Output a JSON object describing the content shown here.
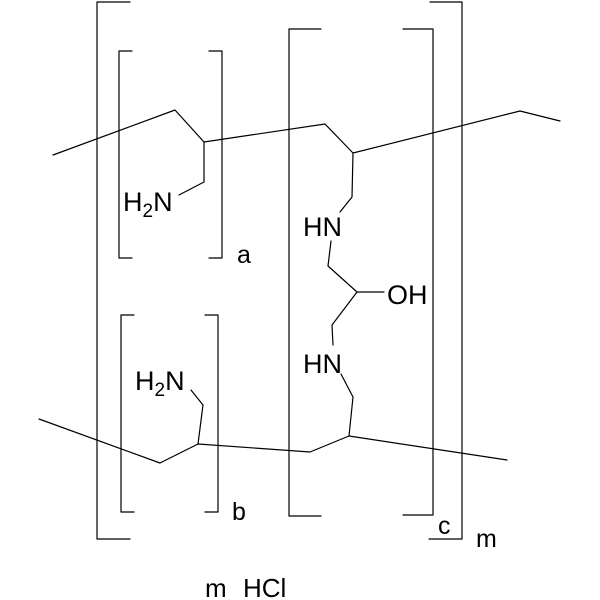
{
  "canvas": {
    "background_color": "#ffffff",
    "line_color": "#000000",
    "width": 600,
    "height": 600
  },
  "atom_labels": {
    "h2n": {
      "h": "H",
      "sub": "2",
      "n": "N"
    },
    "hn": "HN",
    "oh": "OH"
  },
  "bracket_labels": {
    "a": "a",
    "b": "b",
    "c": "c",
    "m": "m"
  },
  "salt_label": {
    "multiplier": "m",
    "formula": "HCl"
  }
}
